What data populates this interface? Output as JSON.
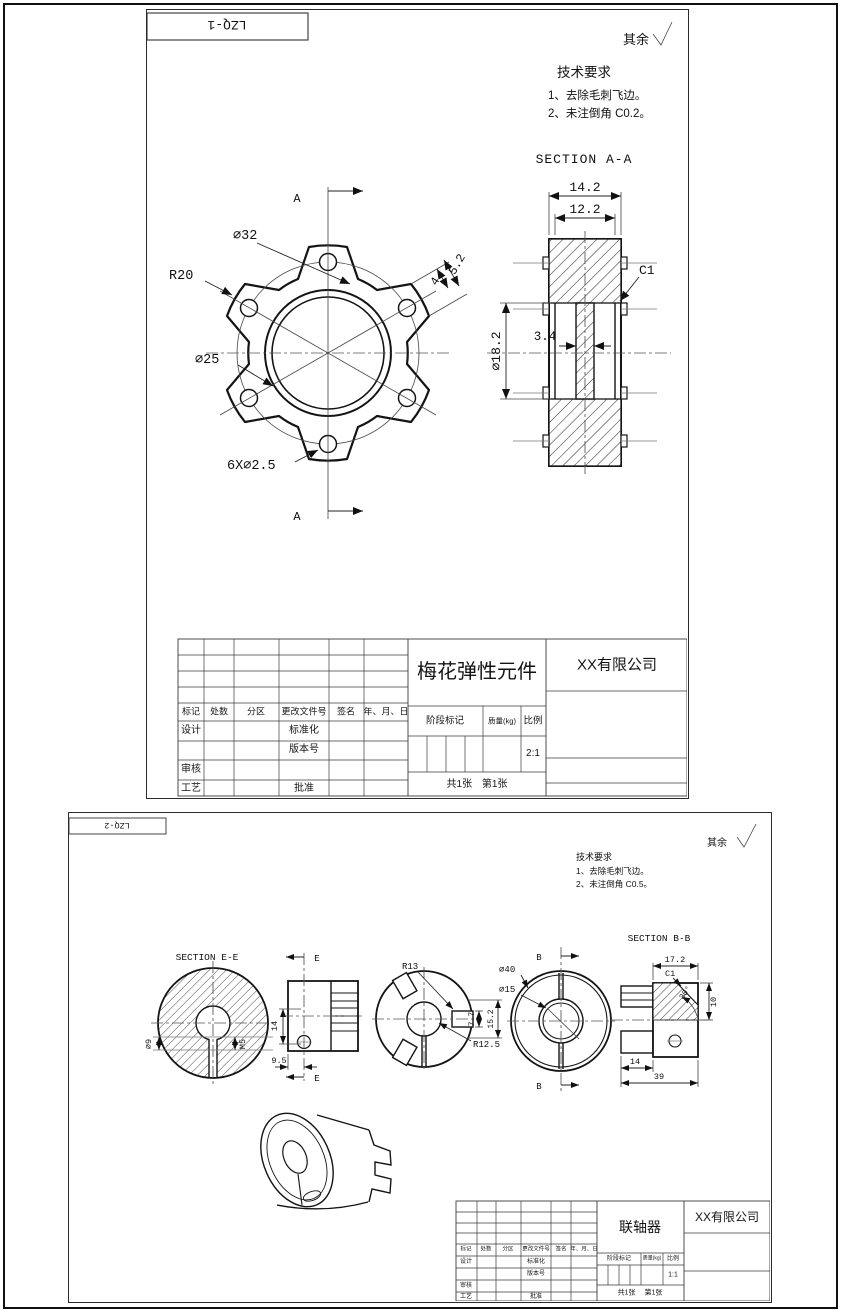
{
  "sheet1": {
    "code": "LZQ-1",
    "surface_note": "其余",
    "tech_title": "技术要求",
    "tech_1": "1、去除毛刺飞边。",
    "tech_2": "2、未注倒角 C0.2。",
    "section_title": "SECTION A-A",
    "dims": {
      "d32": "∅32",
      "r20": "R20",
      "d25": "∅25",
      "holes": "6X∅2.5",
      "w52": "5.2",
      "w4": "4",
      "cut": "A",
      "w142": "14.2",
      "w122": "12.2",
      "c1": "C1",
      "bore": "∅18.2",
      "web": "3.4"
    },
    "tb": {
      "part": "梅花弹性元件",
      "company": "XX有限公司",
      "scale": "2:1",
      "sheets": "共1张 第1张"
    }
  },
  "sheet2": {
    "code": "LZQ-2",
    "surface_note": "其余",
    "tech_title": "技术要求",
    "tech_1": "1、去除毛刺飞边。",
    "tech_2": "2、未注倒角 C0.5。",
    "section_e": "SECTION E-E",
    "section_b": "SECTION B-B",
    "dims": {
      "d9": "∅9",
      "m5": "M5",
      "h14": "14",
      "d95": "9.5",
      "cutE": "E",
      "r13": "R13",
      "r125": "R12.5",
      "w77": "7.7",
      "w152": "15.2",
      "d40": "∅40",
      "d15": "∅15",
      "cutB": "B",
      "w172": "17.2",
      "c1": "C1",
      "w10": "10",
      "a30": "30°",
      "w14": "14",
      "w39": "39"
    },
    "tb": {
      "part": "联轴器",
      "company": "XX有限公司",
      "scale": "1:1",
      "sheets": "共1张 第1张"
    }
  },
  "tb_common": {
    "headers": [
      "标记",
      "处数",
      "分区",
      "更改文件号",
      "签名",
      "年、月、日"
    ],
    "design": "设计",
    "standardize": "标准化",
    "version": "版本号",
    "audit": "审核",
    "process": "工艺",
    "approve": "批准",
    "stage": "阶段标记",
    "mass": "质量(kg)",
    "scale_label": "比例"
  }
}
